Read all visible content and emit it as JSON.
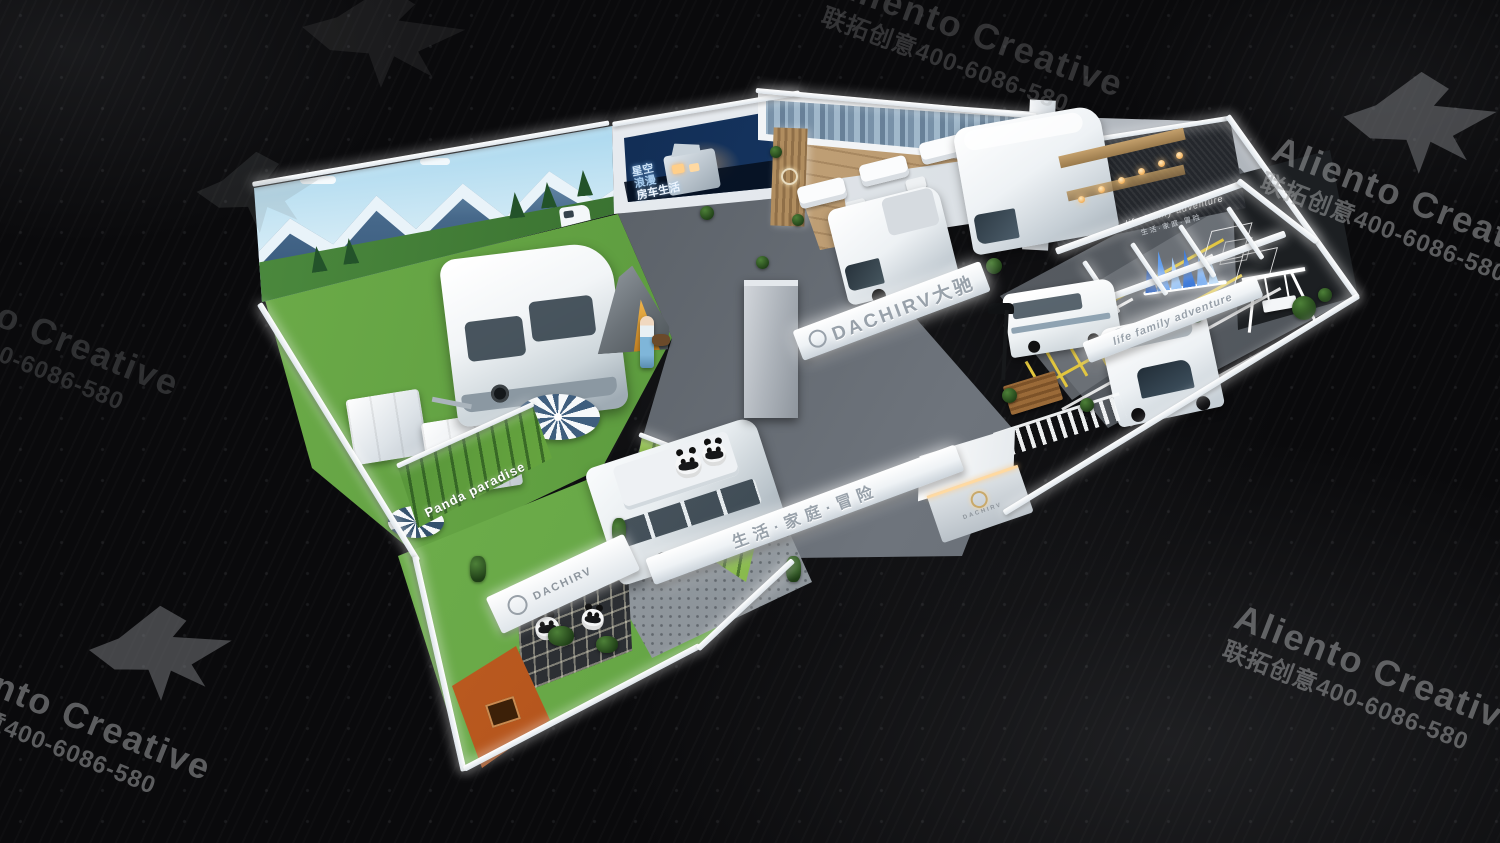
{
  "title": "DACHIRV 大驰 exhibition booth 3D render",
  "watermark": {
    "brand": "Aliento Creative",
    "contact": "联拓创意400-6086-580"
  },
  "signs": {
    "main_beam": "DACHIRV大驰",
    "front_beam": "生活·家庭·冒险",
    "right_beam": "life family adventure",
    "feature_wall_en": "life family adventure",
    "feature_wall_cn": "生活·家庭·冒险",
    "panda_wall": "Panda paradise",
    "led_line1": "星空",
    "led_line2": "浪漫",
    "led_line3": "房车生活",
    "reception_logo": "DACHIRV",
    "panda_zone_logo": "DACHIRV"
  },
  "colors": {
    "background": "#0a0a0c",
    "booth_white": "#f2f4f7",
    "grass": "#66a84a",
    "wood_floor": "#c2a077",
    "asphalt": "#5b6066",
    "marking_yellow": "#e2c63e",
    "orange_wall": "#c2571d",
    "led_navy": "#0d2140",
    "mural_sky": "#a6d6ee",
    "watermark_gray": "#9c9ea0"
  }
}
